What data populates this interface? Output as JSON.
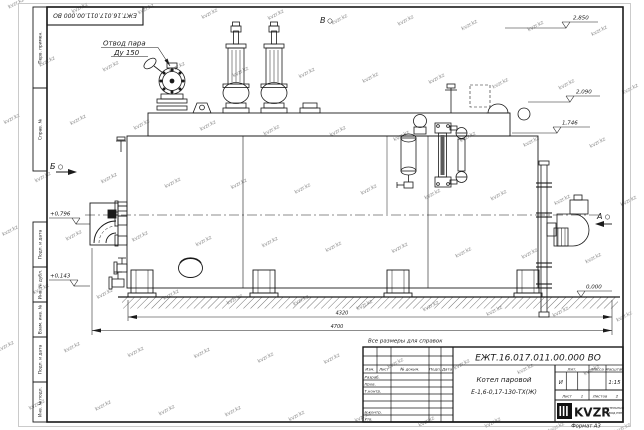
{
  "watermark": "kvzr.kz",
  "sheet": {
    "format_note": "Формат А3",
    "top_doc_number": "ЕЖТ.16.017.011.00.000  ВО",
    "margin_stamps": [
      "Перв. примен.",
      "Справ. №",
      "Подп. и дата",
      "Инв. № дубл.",
      "Взам. инв. №",
      "Подп. и дата",
      "Инв. № подл."
    ]
  },
  "drawing": {
    "callout": {
      "line1": "Отвод пара",
      "line2": "Ду 150"
    },
    "views": {
      "a": "А",
      "b": "Б",
      "v": "В"
    },
    "elevations": {
      "e2850": "2,850",
      "e2090": "2,090",
      "e1746": "1,746",
      "e0000": "0,000",
      "e0796": "+0,796",
      "e0143": "+0,143"
    },
    "dims": {
      "inner": "4320",
      "overall": "4700"
    },
    "note": "Все размеры для справок"
  },
  "title_block": {
    "doc_number": "ЕЖТ.16.017.011.00.000  ВО",
    "product_line1": "Котел паровой",
    "product_line2": "Е-1,6-0,17-130-ТХ(Ж)",
    "cols": {
      "izm": "Изм.",
      "list": "Лист",
      "doc": "№ докум.",
      "podp": "Подп.",
      "data": "Дата"
    },
    "rows": {
      "razrab": "Разраб.",
      "prov": "Пров.",
      "tkontr": "Т.контр.",
      "nkontr": "Н.контр.",
      "utv": "Утв."
    },
    "lit": {
      "header": "Лит.",
      "value": "И"
    },
    "mass": {
      "header": "Масса"
    },
    "scale": {
      "header": "Масштаб",
      "value": "1:15"
    },
    "sheet_row": {
      "list_label": "Лист",
      "list_value": "1",
      "listov_label": "Листов",
      "listov_value": "2"
    },
    "logo": {
      "text": "KVZR",
      "sub1": "КОТЕЛЬНЫЙ",
      "sub2": "ЗАВОД РЭП"
    }
  }
}
